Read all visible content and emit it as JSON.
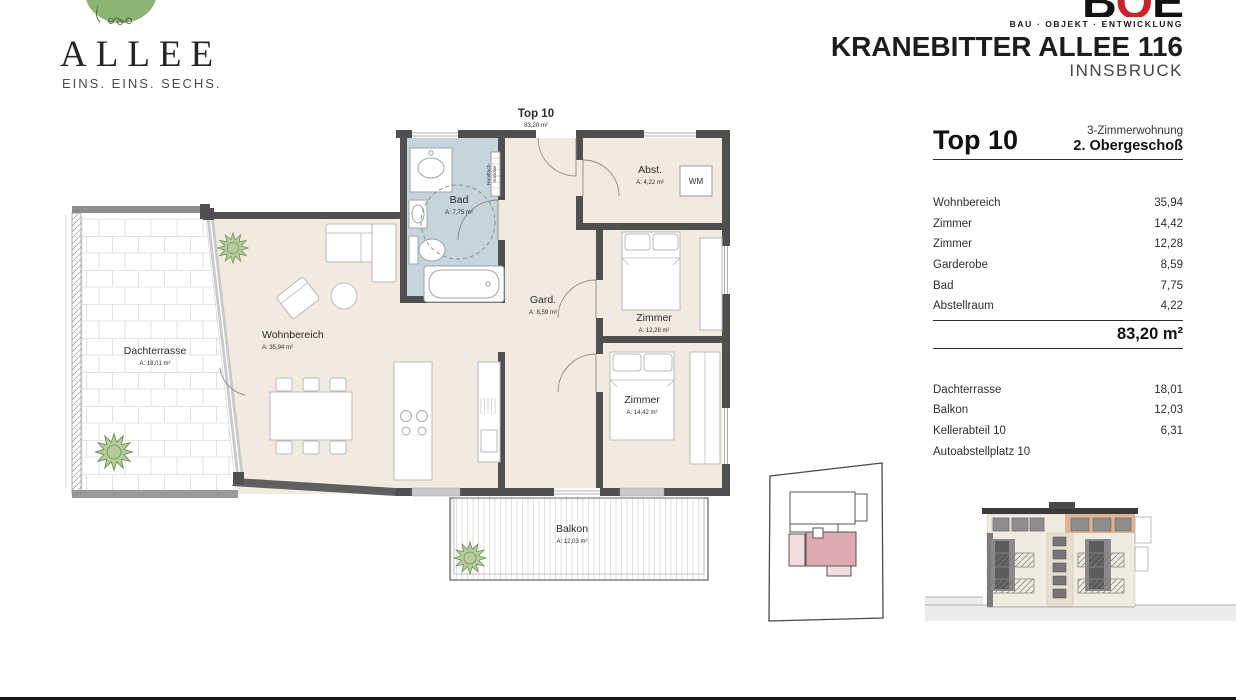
{
  "branding": {
    "allee_title": "ALLEE",
    "allee_subtitle": "EINS. EINS. SECHS.",
    "boe_letter_1": "B",
    "boe_letter_2": "O",
    "boe_letter_3": "E",
    "boe_tagline": "BAU · OBJEKT · ENTWICKLUNG",
    "project_title": "KRANEBITTER ALLEE 116",
    "project_city": "INNSBRUCK"
  },
  "plan": {
    "title": "Top 10",
    "title_area": "83,20 m²",
    "rooms": {
      "wohnbereich": {
        "name": "Wohnbereich",
        "area": "A: 35,94 m²"
      },
      "zimmer_klein": {
        "name": "Zimmer",
        "area": "A: 12,28 m²"
      },
      "zimmer_gross": {
        "name": "Zimmer",
        "area": "A: 14,42 m²"
      },
      "garderobe": {
        "name": "Gard.",
        "area": "A: 8,59 m²"
      },
      "bad": {
        "name": "Bad",
        "area": "A: 7,75 m²"
      },
      "abstellraum": {
        "name": "Abst.",
        "area": "A: 4,22 m²"
      },
      "dachterrasse": {
        "name": "Dachterrasse",
        "area": "A: 18,01 m²"
      },
      "balkon": {
        "name": "Balkon",
        "area": "A: 12,03 m²"
      }
    },
    "fixtures": {
      "wm": "WM",
      "handtuch_line1": "Handtuch-",
      "handtuch_line2": "trockner"
    }
  },
  "info": {
    "unit": "Top 10",
    "unit_type": "3-Zimmerwohnung",
    "floor": "2. Obergeschoß",
    "rows": [
      {
        "label": "Wohnbereich",
        "value": "35,94"
      },
      {
        "label": "Zimmer",
        "value": "14,42"
      },
      {
        "label": "Zimmer",
        "value": "12,28"
      },
      {
        "label": "Garderobe",
        "value": "8,59"
      },
      {
        "label": "Bad",
        "value": "7,75"
      },
      {
        "label": "Abstellraum",
        "value": "4,22"
      }
    ],
    "total": "83,20 m²",
    "extras": [
      {
        "label": "Dachterrasse",
        "value": "18,01"
      },
      {
        "label": "Balkon",
        "value": "12,03"
      },
      {
        "label": "Kellerabteil 10",
        "value": "6,31"
      },
      {
        "label": "Autoabstellplatz 10",
        "value": ""
      }
    ]
  },
  "colors": {
    "floor_cream": "#f1ebdf",
    "bad_blue": "#c6d4db",
    "wall_dark": "#4f4f4f",
    "highlight_pink": "#dfa9b2",
    "highlight_pink_light": "#f3dcdd",
    "elevation_orange": "#e2b392",
    "tree_green": "#8cb573",
    "boe_red": "#cc2229"
  }
}
